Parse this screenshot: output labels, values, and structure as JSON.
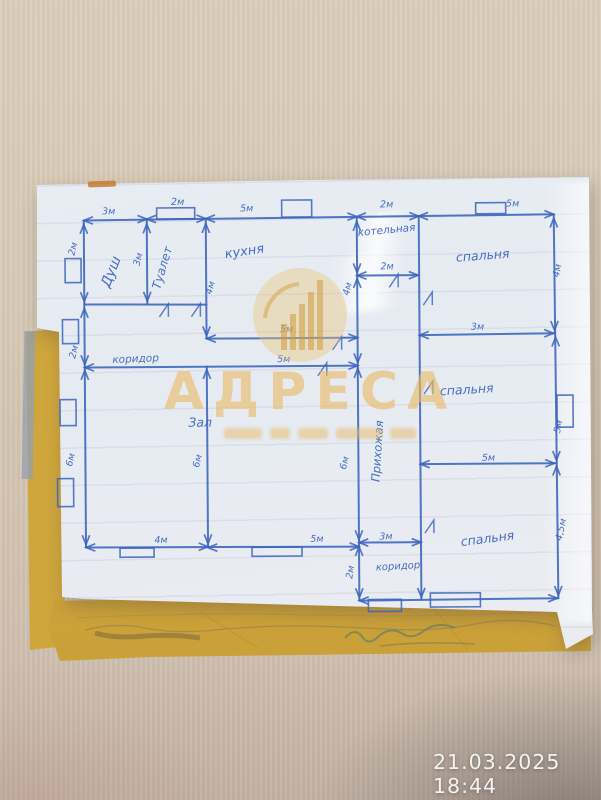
{
  "photo": {
    "timestamp": "21.03.2025 18:44"
  },
  "watermark": {
    "title": "АДРЕСА"
  },
  "colors": {
    "ink": "#3a64bd",
    "gold": "#e7b860",
    "paper": "#e9edf4",
    "yellow": "#cfa63c"
  },
  "floor_plan": {
    "room_labels": [
      {
        "text": "Душ",
        "x": 116,
        "y": 272,
        "r": -68,
        "s": 14
      },
      {
        "text": "Туалет",
        "x": 167,
        "y": 268,
        "r": -73,
        "s": 12
      },
      {
        "text": "кухня",
        "x": 246,
        "y": 255,
        "r": -8,
        "s": 13
      },
      {
        "text": "котельная",
        "x": 388,
        "y": 234,
        "r": -5,
        "s": 10.5
      },
      {
        "text": "спальня",
        "x": 484,
        "y": 261,
        "r": -4,
        "s": 12.5
      },
      {
        "text": "коридор",
        "x": 136,
        "y": 361,
        "r": -2,
        "s": 10.5
      },
      {
        "text": "Зал",
        "x": 200,
        "y": 426,
        "r": 0,
        "s": 12.5
      },
      {
        "text": "Прихожая",
        "x": 381,
        "y": 452,
        "r": -86,
        "s": 11.5
      },
      {
        "text": "спальня",
        "x": 467,
        "y": 395,
        "r": -3,
        "s": 12.5
      },
      {
        "text": "спальня",
        "x": 487,
        "y": 544,
        "r": -7,
        "s": 12.5
      },
      {
        "text": "коридор",
        "x": 397,
        "y": 570,
        "r": -3,
        "s": 10
      }
    ],
    "dim_labels": [
      {
        "text": "3м",
        "x": 110,
        "y": 213
      },
      {
        "text": "2м",
        "x": 179,
        "y": 204
      },
      {
        "text": "5м",
        "x": 248,
        "y": 211
      },
      {
        "text": "2м",
        "x": 388,
        "y": 208
      },
      {
        "text": "5м",
        "x": 514,
        "y": 208
      },
      {
        "text": "2м",
        "x": 77,
        "y": 248,
        "r": -75
      },
      {
        "text": "2м",
        "x": 77,
        "y": 351,
        "r": -75
      },
      {
        "text": "6м",
        "x": 73,
        "y": 459,
        "r": -75
      },
      {
        "text": "3м",
        "x": 142,
        "y": 259,
        "r": -75
      },
      {
        "text": "4м",
        "x": 214,
        "y": 288,
        "r": -75
      },
      {
        "text": "4м",
        "x": 351,
        "y": 290,
        "r": -75
      },
      {
        "text": "6м",
        "x": 200,
        "y": 461,
        "r": -75
      },
      {
        "text": "6м",
        "x": 347,
        "y": 464,
        "r": -75
      },
      {
        "text": "4м",
        "x": 561,
        "y": 273,
        "r": -78
      },
      {
        "text": "5м",
        "x": 561,
        "y": 429,
        "r": -78
      },
      {
        "text": "4,5м",
        "x": 563,
        "y": 532,
        "r": -78
      },
      {
        "text": "5м",
        "x": 287,
        "y": 332
      },
      {
        "text": "5м",
        "x": 284,
        "y": 362
      },
      {
        "text": "2м",
        "x": 388,
        "y": 270
      },
      {
        "text": "3м",
        "x": 478,
        "y": 331
      },
      {
        "text": "5м",
        "x": 488,
        "y": 462
      },
      {
        "text": "4м",
        "x": 160,
        "y": 542
      },
      {
        "text": "5м",
        "x": 316,
        "y": 542
      },
      {
        "text": "3м",
        "x": 385,
        "y": 540
      },
      {
        "text": "2м",
        "x": 352,
        "y": 573,
        "r": -80
      }
    ],
    "walls": [
      [
        85,
        219,
        555,
        216
      ],
      [
        85,
        219,
        85,
        546
      ],
      [
        85,
        546,
        358,
        547
      ],
      [
        555,
        216,
        557,
        600
      ],
      [
        358,
        601,
        557,
        600
      ],
      [
        358,
        218,
        358,
        601
      ],
      [
        420,
        217,
        420,
        600
      ],
      [
        148,
        218,
        148,
        303
      ],
      [
        85,
        303,
        207,
        304
      ],
      [
        207,
        218,
        207,
        338
      ],
      [
        207,
        338,
        358,
        338
      ],
      [
        85,
        366,
        358,
        366
      ],
      [
        207,
        366,
        207,
        546
      ],
      [
        358,
        276,
        419,
        276
      ],
      [
        420,
        336,
        555,
        335
      ],
      [
        420,
        465,
        555,
        465
      ],
      [
        358,
        543,
        420,
        543
      ]
    ],
    "arrows": [
      [
        85,
        219,
        180
      ],
      [
        148,
        218,
        0
      ],
      [
        148,
        218,
        180
      ],
      [
        207,
        218,
        0
      ],
      [
        207,
        218,
        180
      ],
      [
        358,
        217,
        0
      ],
      [
        358,
        217,
        180
      ],
      [
        420,
        217,
        0
      ],
      [
        420,
        217,
        180
      ],
      [
        555,
        216,
        0
      ],
      [
        85,
        223,
        -90
      ],
      [
        85,
        300,
        90
      ],
      [
        85,
        307,
        -90
      ],
      [
        85,
        363,
        90
      ],
      [
        85,
        369,
        -90
      ],
      [
        85,
        543,
        90
      ],
      [
        148,
        223,
        -90
      ],
      [
        148,
        300,
        90
      ],
      [
        207,
        223,
        -90
      ],
      [
        207,
        335,
        90
      ],
      [
        207,
        369,
        -90
      ],
      [
        207,
        543,
        90
      ],
      [
        358,
        222,
        -90
      ],
      [
        358,
        273,
        90
      ],
      [
        358,
        279,
        -90
      ],
      [
        358,
        363,
        90
      ],
      [
        358,
        369,
        -90
      ],
      [
        358,
        540,
        90
      ],
      [
        358,
        547,
        -90
      ],
      [
        358,
        598,
        90
      ],
      [
        555,
        220,
        -90
      ],
      [
        555,
        332,
        90
      ],
      [
        556,
        339,
        -90
      ],
      [
        556,
        462,
        90
      ],
      [
        556,
        468,
        -90
      ],
      [
        557,
        597,
        90
      ],
      [
        207,
        338,
        180
      ],
      [
        358,
        338,
        0
      ],
      [
        85,
        366,
        180
      ],
      [
        358,
        366,
        0
      ],
      [
        358,
        276,
        180
      ],
      [
        419,
        276,
        0
      ],
      [
        420,
        336,
        180
      ],
      [
        554,
        335,
        0
      ],
      [
        420,
        465,
        180
      ],
      [
        554,
        465,
        0
      ],
      [
        85,
        546,
        180
      ],
      [
        207,
        546,
        0
      ],
      [
        207,
        547,
        180
      ],
      [
        358,
        547,
        0
      ],
      [
        358,
        543,
        180
      ],
      [
        420,
        543,
        0
      ],
      [
        358,
        601,
        180
      ],
      [
        556,
        600,
        0
      ],
      [
        420,
        598,
        90
      ]
    ],
    "windows": [
      [
        158,
        207,
        38,
        11
      ],
      [
        283,
        200,
        30,
        17
      ],
      [
        477,
        204,
        30,
        11
      ],
      [
        66,
        257,
        16,
        24
      ],
      [
        63,
        318,
        16,
        24
      ],
      [
        60,
        398,
        16,
        26
      ],
      [
        57,
        477,
        16,
        28
      ],
      [
        557,
        397,
        16,
        32
      ],
      [
        119,
        547,
        34,
        9
      ],
      [
        251,
        547,
        50,
        9
      ],
      [
        367,
        600,
        33,
        12
      ],
      [
        429,
        594,
        50,
        14
      ]
    ],
    "door_marks": [
      [
        160,
        316
      ],
      [
        192,
        316
      ],
      [
        333,
        350
      ],
      [
        318,
        376
      ],
      [
        390,
        288
      ],
      [
        424,
        306
      ],
      [
        424,
        395
      ],
      [
        424,
        534
      ]
    ]
  }
}
